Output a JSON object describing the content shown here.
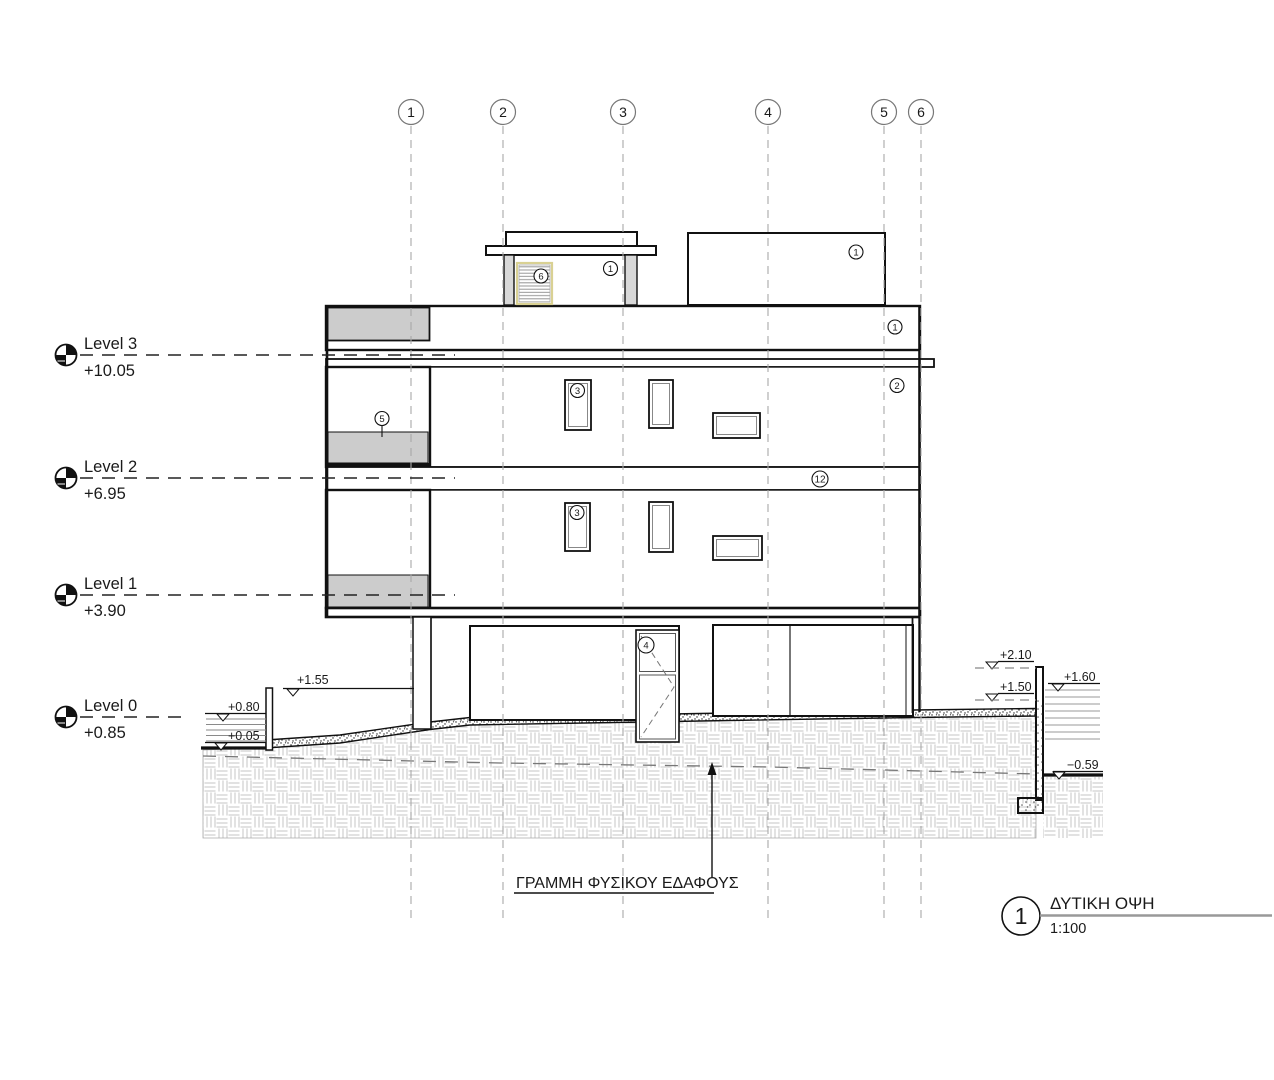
{
  "drawing": {
    "grid_bubbles": [
      {
        "label": "1"
      },
      {
        "label": "2"
      },
      {
        "label": "3"
      },
      {
        "label": "4"
      },
      {
        "label": "5"
      },
      {
        "label": "6"
      }
    ],
    "levels": [
      {
        "name": "Level 3",
        "elevation": "+10.05"
      },
      {
        "name": "Level 2",
        "elevation": "+6.95"
      },
      {
        "name": "Level 1",
        "elevation": "+3.90"
      },
      {
        "name": "Level 0",
        "elevation": "+0.85"
      }
    ],
    "keynotes": {
      "penthouse_left": "1",
      "penthouse_right": "1",
      "parapet": "1",
      "facade_upper": "2",
      "window_upper": "3",
      "window_lower": "3",
      "door": "4",
      "balcony": "5",
      "louver": "6",
      "midband": "12"
    },
    "spot_elevations": {
      "left_wall_top": "+1.55",
      "left_upper": "+0.80",
      "left_lower": "+0.05",
      "right_upper": "+2.10",
      "right_mid": "+1.50",
      "neighbor": "+1.60",
      "right_low": "−0.59"
    },
    "ground_line_label": "ΓΡΑΜΜΗ ΦΥΣΙΚΟΥ ΕΔΑΦΟΥΣ",
    "title": {
      "number": "1",
      "name": "ΔΥΤΙΚΗ ΟΨΗ",
      "scale": "1:100"
    }
  }
}
